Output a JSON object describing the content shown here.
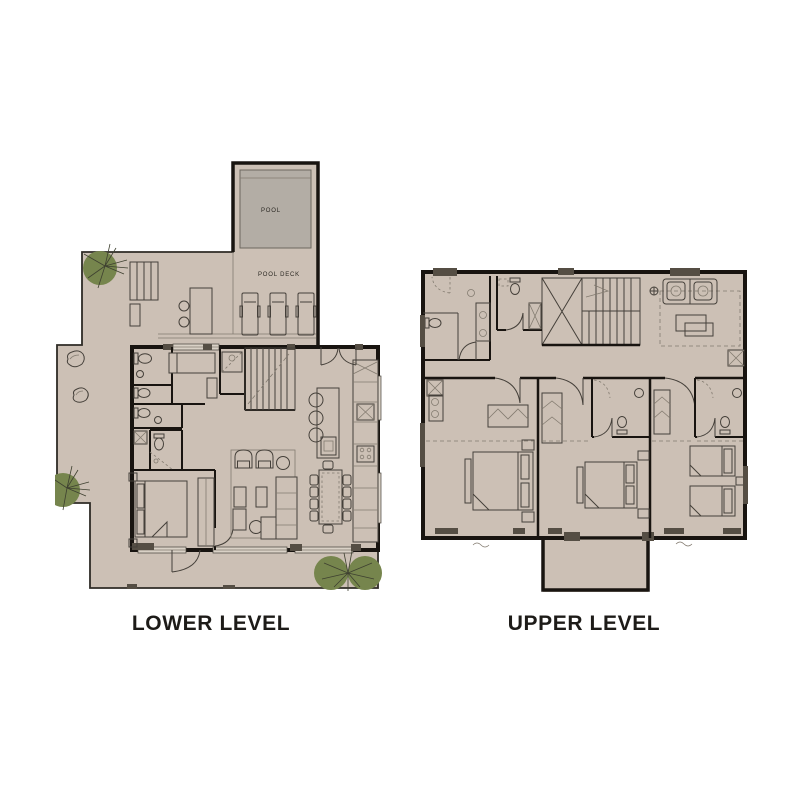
{
  "plans": {
    "lower": {
      "caption": "LOWER LEVEL",
      "labels": {
        "pool": "POOL",
        "pool_deck": "POOL DECK"
      }
    },
    "upper": {
      "caption": "UPPER LEVEL"
    }
  },
  "colors": {
    "bg": "#ffffff",
    "floor": "#ccc0b5",
    "pool_water": "#b3ada5",
    "wall": "#181410",
    "line": "#45403a",
    "line_light": "#837b70",
    "dark_fill": "#554e44",
    "window_fill": "#d9d1c6",
    "tree_fill": "#76854d",
    "tree_line": "#3e4030",
    "caption_text": "#1d1b18",
    "plan_text": "#2a2722"
  }
}
